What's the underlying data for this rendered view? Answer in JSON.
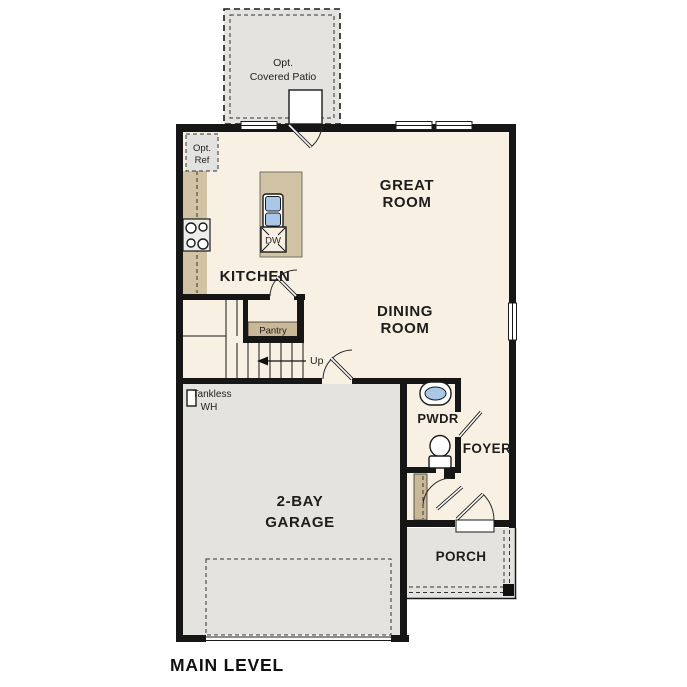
{
  "plan": {
    "title": "MAIN LEVEL",
    "rooms": {
      "great_room": [
        "GREAT",
        "ROOM"
      ],
      "dining_room": [
        "DINING",
        "ROOM"
      ],
      "kitchen": "KITCHEN",
      "garage": [
        "2-BAY",
        "GARAGE"
      ],
      "pwdr": "PWDR",
      "foyer": "FOYER",
      "porch": "PORCH",
      "patio": [
        "Opt.",
        "Covered Patio"
      ],
      "pantry": "Pantry",
      "opt_ref": [
        "Opt.",
        "Ref"
      ],
      "tankless": [
        "Tankless",
        "WH"
      ],
      "stairs_direction": "Up",
      "dishwasher": "DW"
    },
    "fixtures": [
      "range-burners",
      "kitchen-island-sink",
      "dishwasher",
      "optional-refrigerator",
      "tankless-water-heater",
      "powder-room-sink",
      "toilet",
      "porch-post"
    ],
    "colors": {
      "wall": "#161616",
      "interior_floor": "#f8f0e2",
      "exterior_concrete": "#e4e3e0",
      "cabinet_tan": "#d2c3a4",
      "shelf_tan": "#c8b897",
      "fixture_blue": "#a9c8e8",
      "background": "#ffffff"
    }
  }
}
